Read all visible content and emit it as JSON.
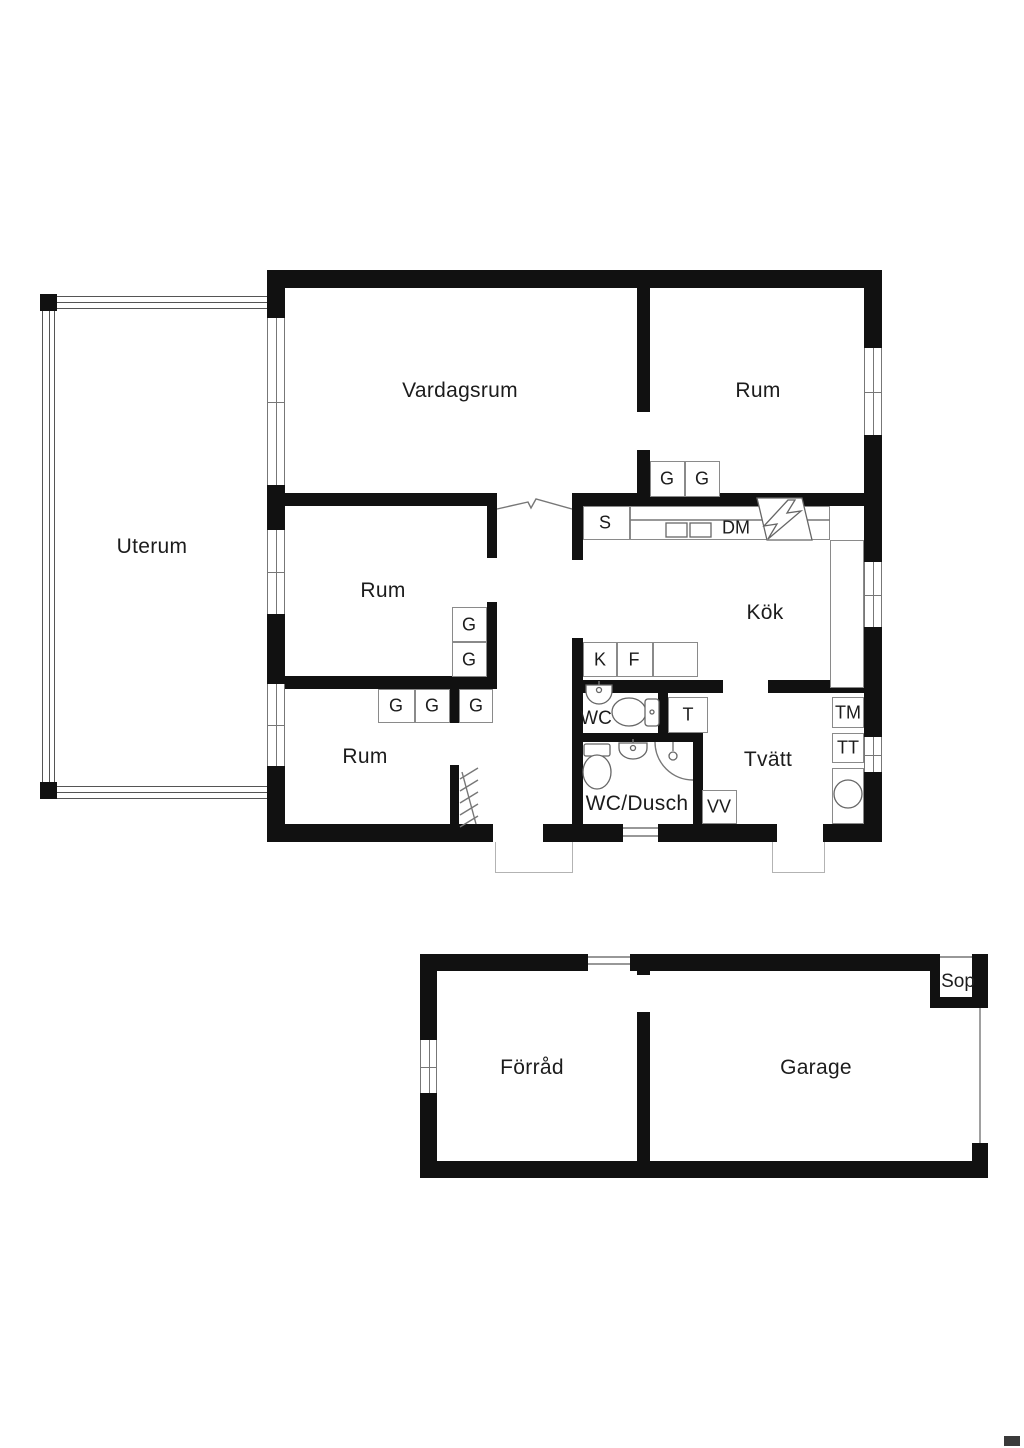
{
  "colors": {
    "wall": "#111111",
    "thin_line": "#8a8a8a",
    "glass_line": "#555555",
    "text": "#1c1c1c",
    "background": "#ffffff"
  },
  "labels": {
    "uterum": "Uterum",
    "vardagsrum": "Vardagsrum",
    "rum": "Rum",
    "kok": "Kök",
    "wc": "WC",
    "wc_dusch": "WC/Dusch",
    "tvatt": "Tvätt",
    "forrad": "Förråd",
    "garage": "Garage",
    "sop": "Sop",
    "g": "G",
    "s": "S",
    "dm": "DM",
    "k": "K",
    "f": "F",
    "t": "T",
    "tm": "TM",
    "tt": "TT",
    "vv": "VV"
  }
}
